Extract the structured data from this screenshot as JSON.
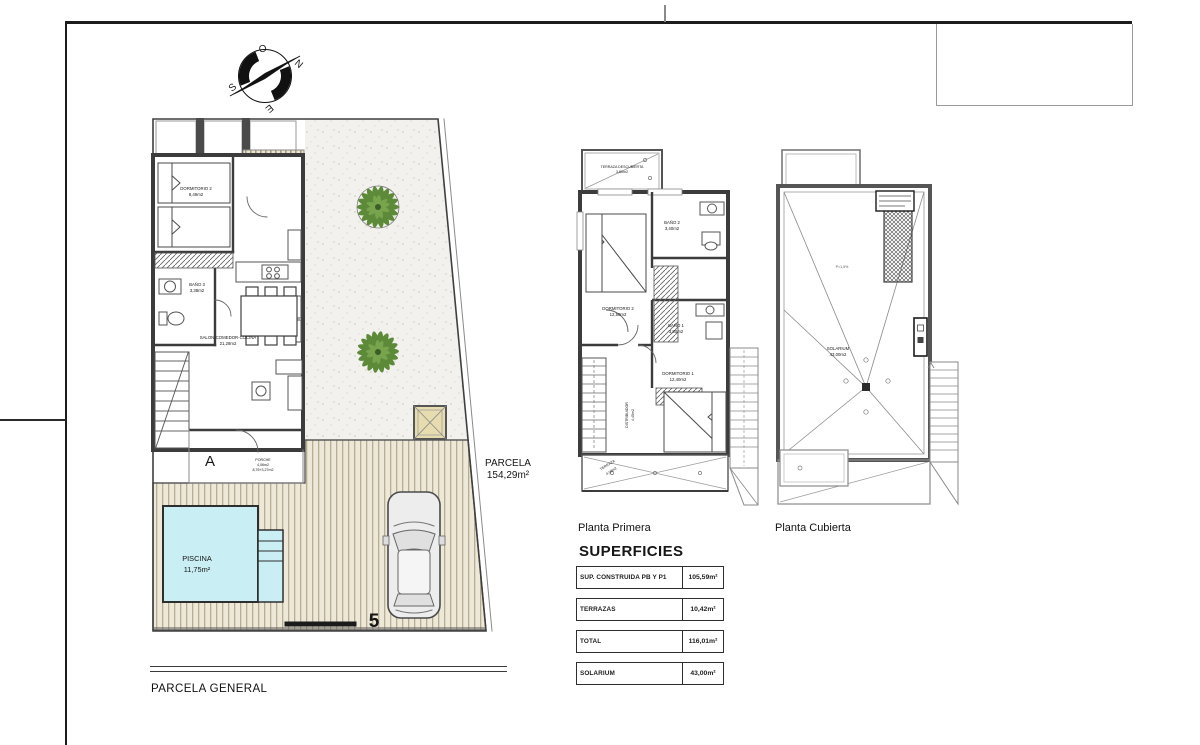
{
  "compass": {
    "o": "O",
    "n": "N",
    "s": "S",
    "e": "E"
  },
  "ground_floor": {
    "caption": "PARCELA GENERAL",
    "section_marker": "A",
    "house_number": "5",
    "dormitorio2": {
      "name": "DORMITORIO 2",
      "area": "8,49m2"
    },
    "bano": {
      "name": "BAÑO 3",
      "area": "3,38m2"
    },
    "salon": {
      "name": "SALON-COMEDOR-COCINA",
      "area": "21,28m2"
    },
    "porche": {
      "name": "PORCHE",
      "area": "4,06m2",
      "area_detail": "8,76+3,27m2"
    },
    "piscina": {
      "name": "PISCINA",
      "area": "11,75m²"
    },
    "parcela": {
      "name": "PARCELA",
      "area": "154,29m²"
    }
  },
  "planta_primera": {
    "title": "Planta Primera",
    "terraza_descubierta": {
      "name": "TERRAZA DESCUBIERTA",
      "area": "3,60m2"
    },
    "dormitorio2": {
      "name": "DORMITORIO 2",
      "area": "12,50m2"
    },
    "bano2": {
      "name": "BAÑO 2",
      "area": "3,40m2"
    },
    "bano1": {
      "name": "BAÑO 1",
      "area": "3,80m2"
    },
    "dormitorio1": {
      "name": "DORMITORIO 1",
      "area": "12,40m2"
    },
    "distribuidor": {
      "name": "DISTRIBUIDOR",
      "area": "4,45m2"
    },
    "terraza": {
      "name": "TERRAZA",
      "area": "4,08m2"
    }
  },
  "planta_cubierta": {
    "title": "Planta Cubierta",
    "solarium": {
      "name": "SOLARIUM",
      "area": "43,00m2"
    },
    "slope": "P=1,5%"
  },
  "superficies": {
    "title": "SUPERFICIES",
    "rows": [
      {
        "label": "SUP. CONSTRUIDA PB Y P1",
        "value": "105,59m²"
      },
      {
        "label": "TERRAZAS",
        "value": "10,42m²"
      },
      {
        "label": "TOTAL",
        "value": "116,01m²"
      },
      {
        "label": "SOLARIUM",
        "value": "43,00m²"
      }
    ]
  },
  "colors": {
    "wall": "#3c3c3c",
    "pool": "#c9eef4",
    "plant": "#5d8a39",
    "deck": "#eee8d8"
  }
}
